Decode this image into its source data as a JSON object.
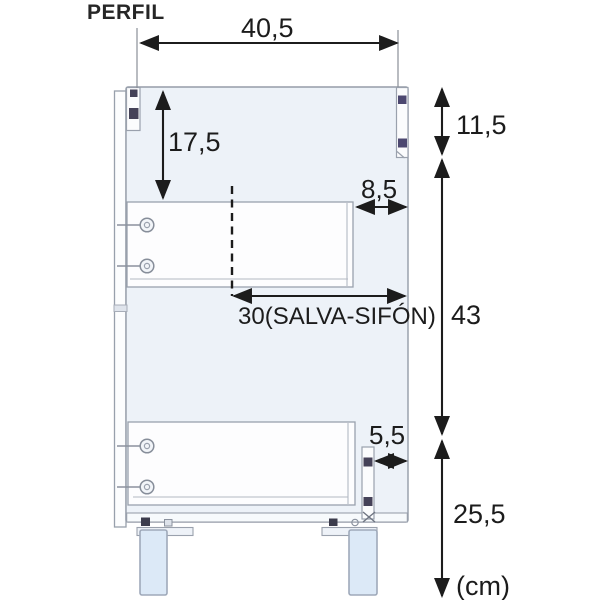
{
  "title": "PERFIL",
  "unit_label": "(cm)",
  "dimensions": {
    "top_depth": "40,5",
    "top_section": "17,5",
    "hinge_zone": "11,5",
    "drawer_back_offset": "8,5",
    "mid_section": "43",
    "siphon_clearance": "30(SALVA-SIFÓN)",
    "slide_back_offset": "5,5",
    "bottom_section": "25,5"
  },
  "colors": {
    "dimension_ink": "#1c1c1c",
    "cabinet_line": "#98a0ac",
    "cabinet_fill": "#edf2f8",
    "drawer_fill": "#fdfdfe",
    "leg_fill": "#dce9f7",
    "hardware_dark": "#454258"
  }
}
